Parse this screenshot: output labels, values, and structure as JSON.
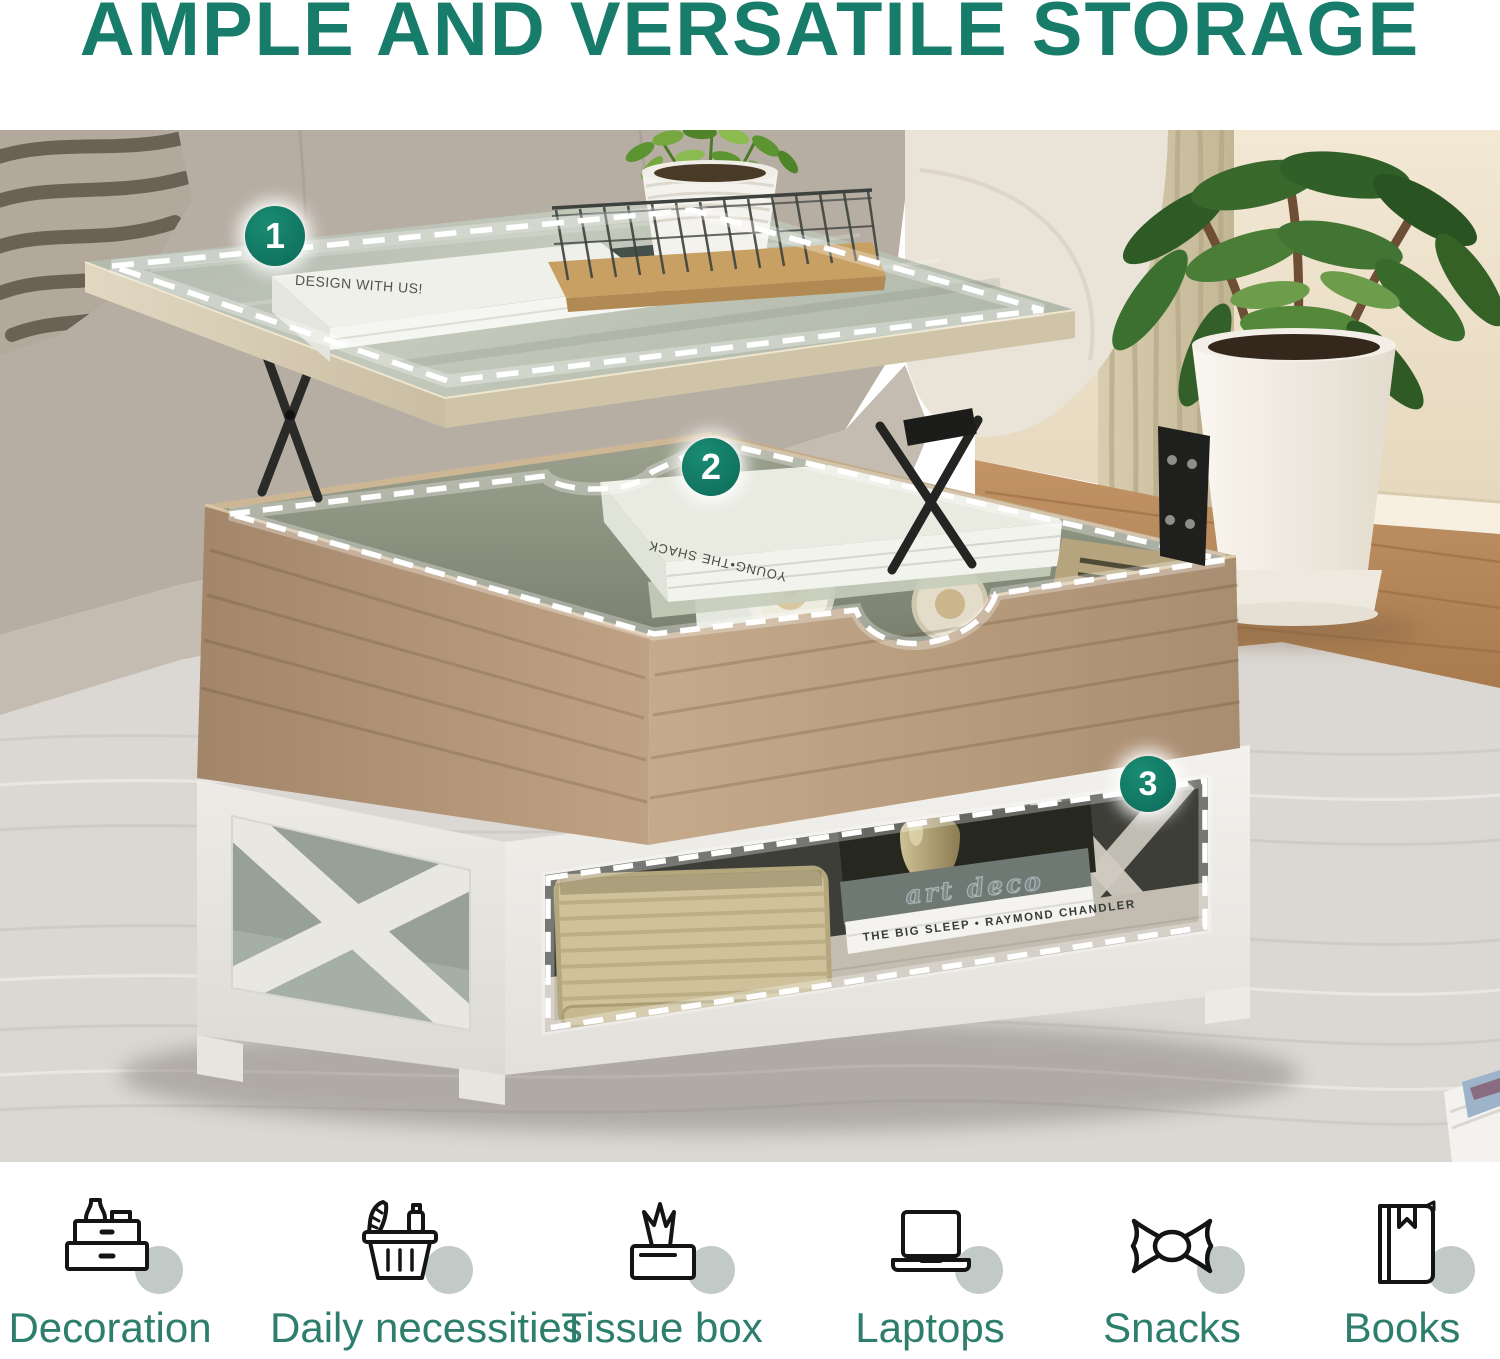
{
  "title": "AMPLE AND VERSATILE STORAGE",
  "colors": {
    "accent_teal": "#177C6A",
    "marker_teal": "#0C6A58",
    "feature_label_teal": "#2D7E6C",
    "icon_circle_grey": "#C2CAC7",
    "dash_outline": "#FFFFFF"
  },
  "scene": {
    "markers": [
      "1",
      "2",
      "3"
    ],
    "texts": {
      "tabletop_book": "DESIGN WITH US!",
      "trunk_book_spine": "YOUNG•THE SHACK",
      "shelf_book_top": "art deco",
      "shelf_book_bottom": "THE BIG SLEEP • RAYMOND CHANDLER"
    }
  },
  "features": [
    {
      "label": "Decoration",
      "icon": "decoration-stand-icon"
    },
    {
      "label": "Daily necessities",
      "icon": "shopping-basket-icon"
    },
    {
      "label": "Tissue box",
      "icon": "tissue-box-icon"
    },
    {
      "label": "Laptops",
      "icon": "laptop-icon"
    },
    {
      "label": "Snacks",
      "icon": "candy-icon"
    },
    {
      "label": "Books",
      "icon": "book-icon"
    }
  ]
}
